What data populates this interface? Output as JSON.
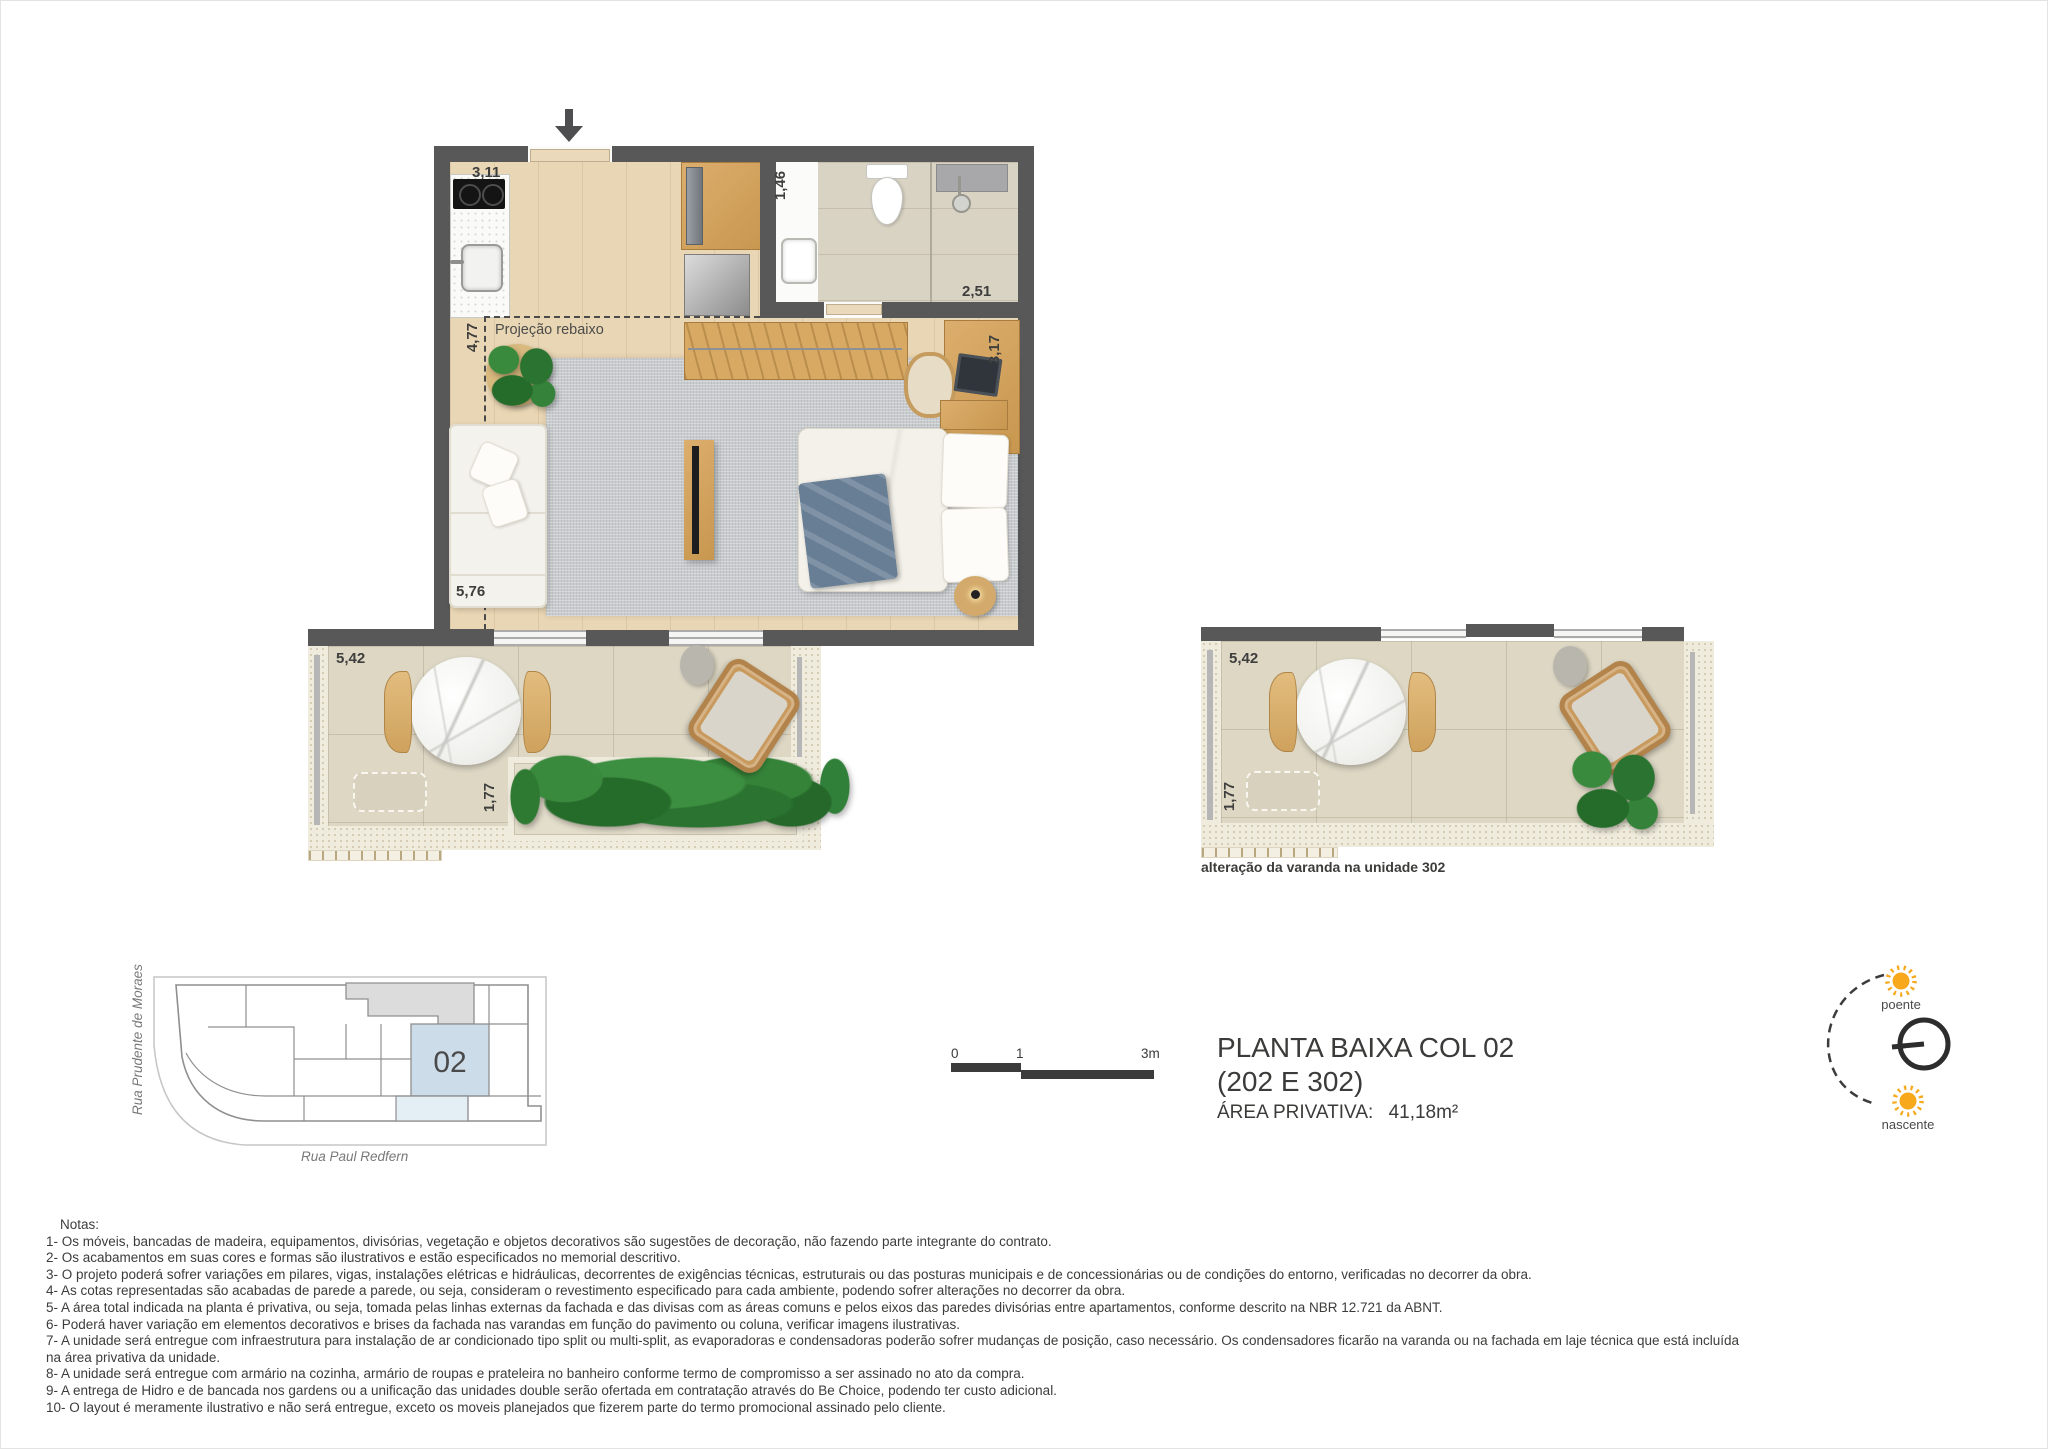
{
  "title": {
    "line1": "PLANTA BAIXA COL 02",
    "line2": "(202 E 302)",
    "area_label": "ÁREA PRIVATIVA:",
    "area_value": "41,18m²"
  },
  "scalebar": {
    "tick0": "0",
    "tick1": "1",
    "tick2": "3m"
  },
  "compass": {
    "west": "poente",
    "east": "nascente"
  },
  "keyplan": {
    "unit": "02",
    "street_left": "Rua Prudente de Moraes",
    "street_bottom": "Rua Paul Redfern"
  },
  "plan": {
    "dim_kitchen": "3,11",
    "dim_bath": "1,46",
    "dim_shower": "2,51",
    "dim_desk": "3,17",
    "dim_left_upper": "4,77",
    "dim_left_lower": "5,76",
    "projecao": "Projeção rebaixo"
  },
  "varanda": {
    "dim_width": "5,42",
    "dim_depth": "1,77"
  },
  "varanda_alt": {
    "dim_width": "5,42",
    "dim_depth": "1,77",
    "caption": "alteração da varanda na unidade 302"
  },
  "notes": {
    "heading": "Notas:",
    "items": [
      "1- Os móveis, bancadas de madeira, equipamentos, divisórias, vegetação e objetos decorativos são sugestões de decoração, não fazendo parte integrante do contrato.",
      "2- Os acabamentos em suas cores e formas são ilustrativos e estão especificados no memorial descritivo.",
      "3- O projeto poderá sofrer variações em pilares, vigas, instalações elétricas e hidráulicas, decorrentes de exigências técnicas, estruturais ou das posturas municipais e de concessionárias ou de condições do entorno, verificadas no decorrer da obra.",
      "4- As cotas representadas são acabadas de parede a parede, ou seja, consideram o revestimento especificado para cada ambiente, podendo sofrer alterações no decorrer da obra.",
      "5- A área total indicada na planta é privativa, ou seja, tomada pelas linhas externas da fachada e das divisas com as áreas comuns e pelos eixos das paredes divisórias entre apartamentos, conforme descrito na NBR 12.721 da ABNT.",
      "6- Poderá haver variação em elementos decorativos e brises da fachada nas varandas em função do pavimento ou coluna, verificar imagens ilustrativas.",
      "7- A unidade será entregue com infraestrutura para instalação de ar condicionado tipo split ou multi-split, as evaporadoras e condensadoras poderão sofrer mudanças de posição, caso necessário. Os condensadores ficarão na varanda ou na fachada em laje técnica que está incluída na área privativa da unidade.",
      "8- A unidade será entregue com armário na cozinha, armário de roupas e prateleira no banheiro conforme termo de compromisso a ser assinado no ato da compra.",
      "9- A entrega de Hidro e de bancada nos gardens ou a unificação das unidades double serão ofertada em contratação através do Be Choice, podendo ter custo adicional.",
      "10- O layout é meramente ilustrativo e não será entregue, exceto os moveis planejados que fizerem parte do termo promocional assinado pelo cliente."
    ]
  }
}
